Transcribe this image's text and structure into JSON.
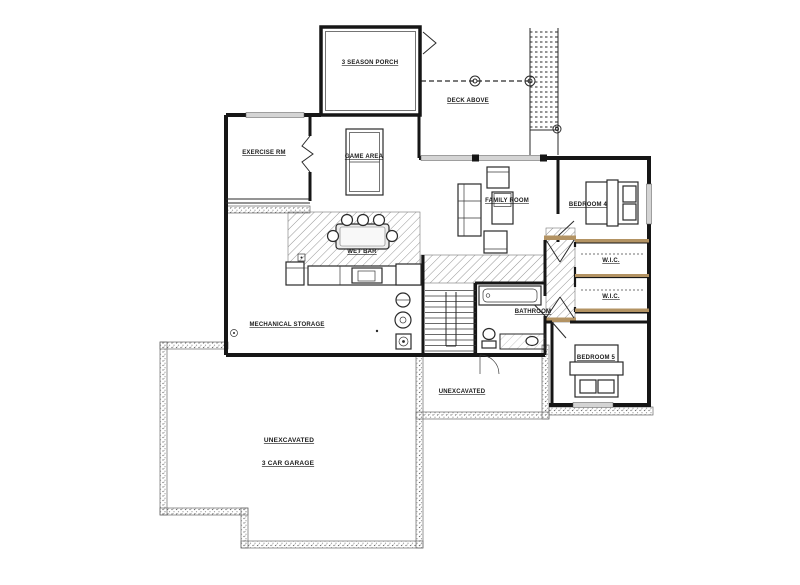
{
  "sheet": {
    "title": "Basement Floor Plan"
  },
  "colors": {
    "wall": "#161616",
    "tan": "#b39363",
    "window": "#d4d4d4",
    "hatch_line": "#8a8a8a",
    "stipple": "#7d7d7d",
    "paper": "#ffffff"
  },
  "rooms": [
    {
      "id": "season-porch",
      "label": "3 SEASON PORCH"
    },
    {
      "id": "deck-above",
      "label": "DECK ABOVE"
    },
    {
      "id": "exercise-rm",
      "label": "EXERCISE RM"
    },
    {
      "id": "game-area",
      "label": "GAME AREA"
    },
    {
      "id": "family-room",
      "label": "FAMILY ROOM"
    },
    {
      "id": "bedroom-4",
      "label": "BEDROOM 4"
    },
    {
      "id": "wic-1",
      "label": "W.I.C."
    },
    {
      "id": "wic-2",
      "label": "W.I.C."
    },
    {
      "id": "bathroom",
      "label": "BATHROOM"
    },
    {
      "id": "wet-bar",
      "label": "WET BAR"
    },
    {
      "id": "mechanical-storage",
      "label": "MECHANICAL STORAGE"
    },
    {
      "id": "bedroom-5",
      "label": "BEDROOM 5"
    },
    {
      "id": "unexcavated-mid",
      "label": "UNEXCAVATED"
    },
    {
      "id": "unexcavated-garage",
      "label": "UNEXCAVATED"
    },
    {
      "id": "garage",
      "label": "3 CAR GARAGE"
    }
  ]
}
